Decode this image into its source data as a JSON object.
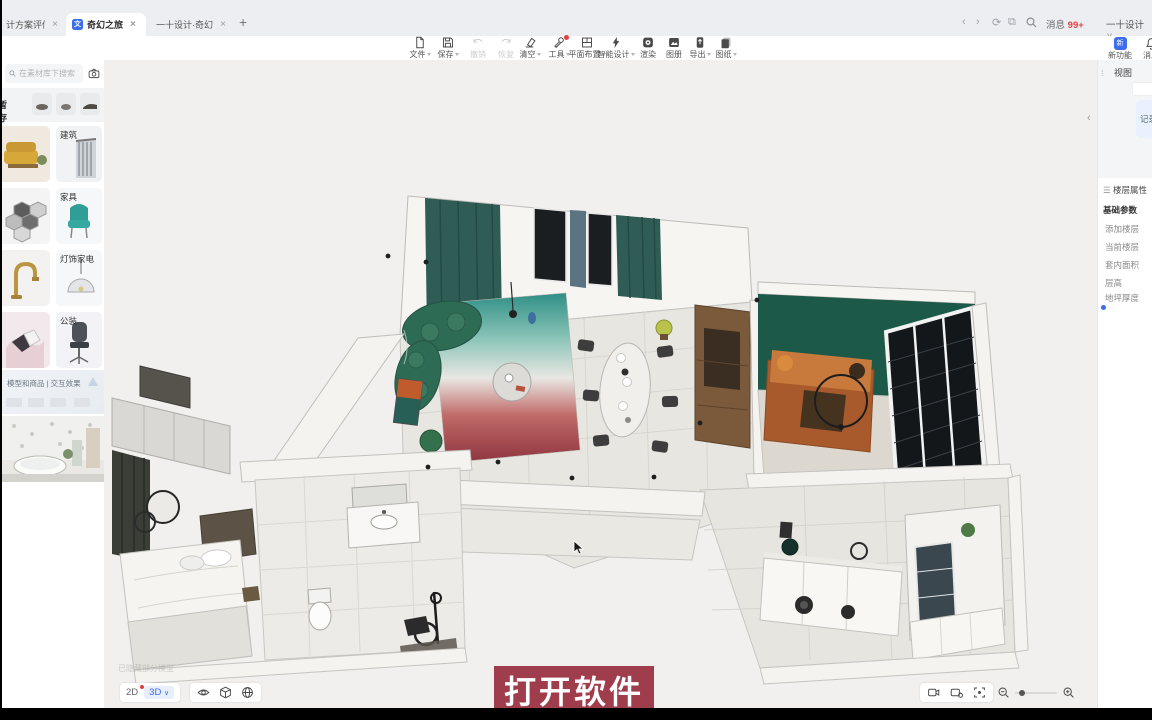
{
  "icons": {
    "close": "×",
    "plus": "+",
    "chevron_down": "∨",
    "collapse": "‹",
    "drag_handle": "⁞",
    "menu": "☰",
    "doc_glyph": "文",
    "new_glyph": "新"
  },
  "browser": {
    "tabs": [
      {
        "title": "计方案评估 - 副本"
      },
      {
        "title": "奇幻之旅"
      },
      {
        "title": "一十设计·奇幻之旅"
      }
    ],
    "messages_label": "消息",
    "messages_badge": "99+",
    "account_label": "一十设计"
  },
  "toolbar": {
    "items": [
      {
        "label": "文件"
      },
      {
        "label": "保存"
      },
      {
        "label": "撤销"
      },
      {
        "label": "恢复"
      },
      {
        "label": "清空"
      },
      {
        "label": "工具"
      },
      {
        "label": "平面布置"
      },
      {
        "label": "智能设计"
      },
      {
        "label": "渲染"
      },
      {
        "label": "图册"
      },
      {
        "label": "导出"
      },
      {
        "label": "图纸"
      }
    ],
    "corner": [
      {
        "label": "新功能"
      },
      {
        "label": "消息"
      }
    ]
  },
  "sidebar": {
    "search_placeholder": "在素材库下搜索",
    "stash_label": "暂存",
    "categories": [
      {
        "label": "建筑"
      },
      {
        "label": "家具"
      },
      {
        "label": "灯饰家电"
      },
      {
        "label": "公装"
      }
    ],
    "banner_title": "模型和商品 | 交互效果"
  },
  "viewport": {
    "caption": "打开软件",
    "mode_2d": "2D",
    "mode_3d": "3D",
    "watermark": "已隐藏部分模型"
  },
  "right_panel": {
    "view_header": "视图",
    "record_button": "记录",
    "floor_section": "楼层属性",
    "basic_params": "基础参数",
    "rows": [
      "添加楼层",
      "当前楼层",
      "套内面积",
      "层高",
      "地坪厚度"
    ]
  },
  "colors": {
    "accent_blue": "#3a6df0",
    "caption_bg": "#a03d4d",
    "badge_red": "#e24545",
    "curtain_teal": "#2f5d55",
    "sofa_green": "#2e6b54",
    "accent_wall_green": "#1d5948",
    "sofa_orange": "#b06030"
  }
}
